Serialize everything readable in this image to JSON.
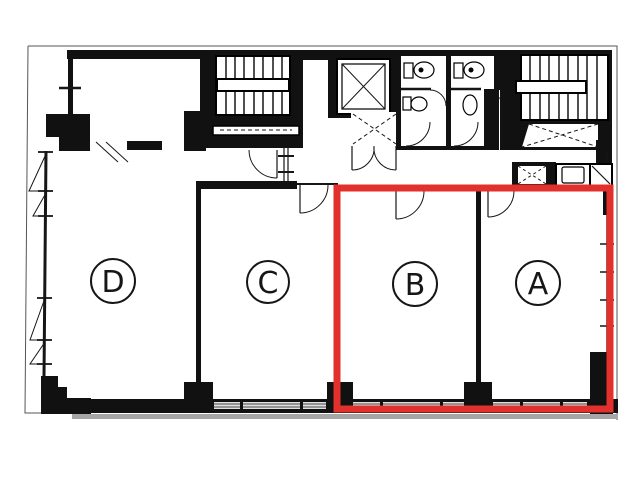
{
  "plan": {
    "kind": "building-floor-plan",
    "background": "#ffffff",
    "rooms": [
      {
        "id": "A",
        "label": "A",
        "highlighted": true
      },
      {
        "id": "B",
        "label": "B",
        "highlighted": true
      },
      {
        "id": "C",
        "label": "C",
        "highlighted": false
      },
      {
        "id": "D",
        "label": "D",
        "highlighted": false
      }
    ],
    "highlight": {
      "color": "#e2302c",
      "style": "thick-rectangle-outline",
      "covers_rooms": "A and B"
    },
    "palette": {
      "walls": "#111111",
      "lines": "#161616",
      "shadow": "#a6a6a6",
      "window_strip": "#e0e0e0"
    },
    "fixtures": [
      "staircase-left-icon",
      "staircase-right-icon",
      "elevator-icon",
      "elevator-hall-dashed-x-icon",
      "wc-toilet-icons",
      "storage-box-icons",
      "door-swing-arcs",
      "window-swing-triangles"
    ]
  }
}
